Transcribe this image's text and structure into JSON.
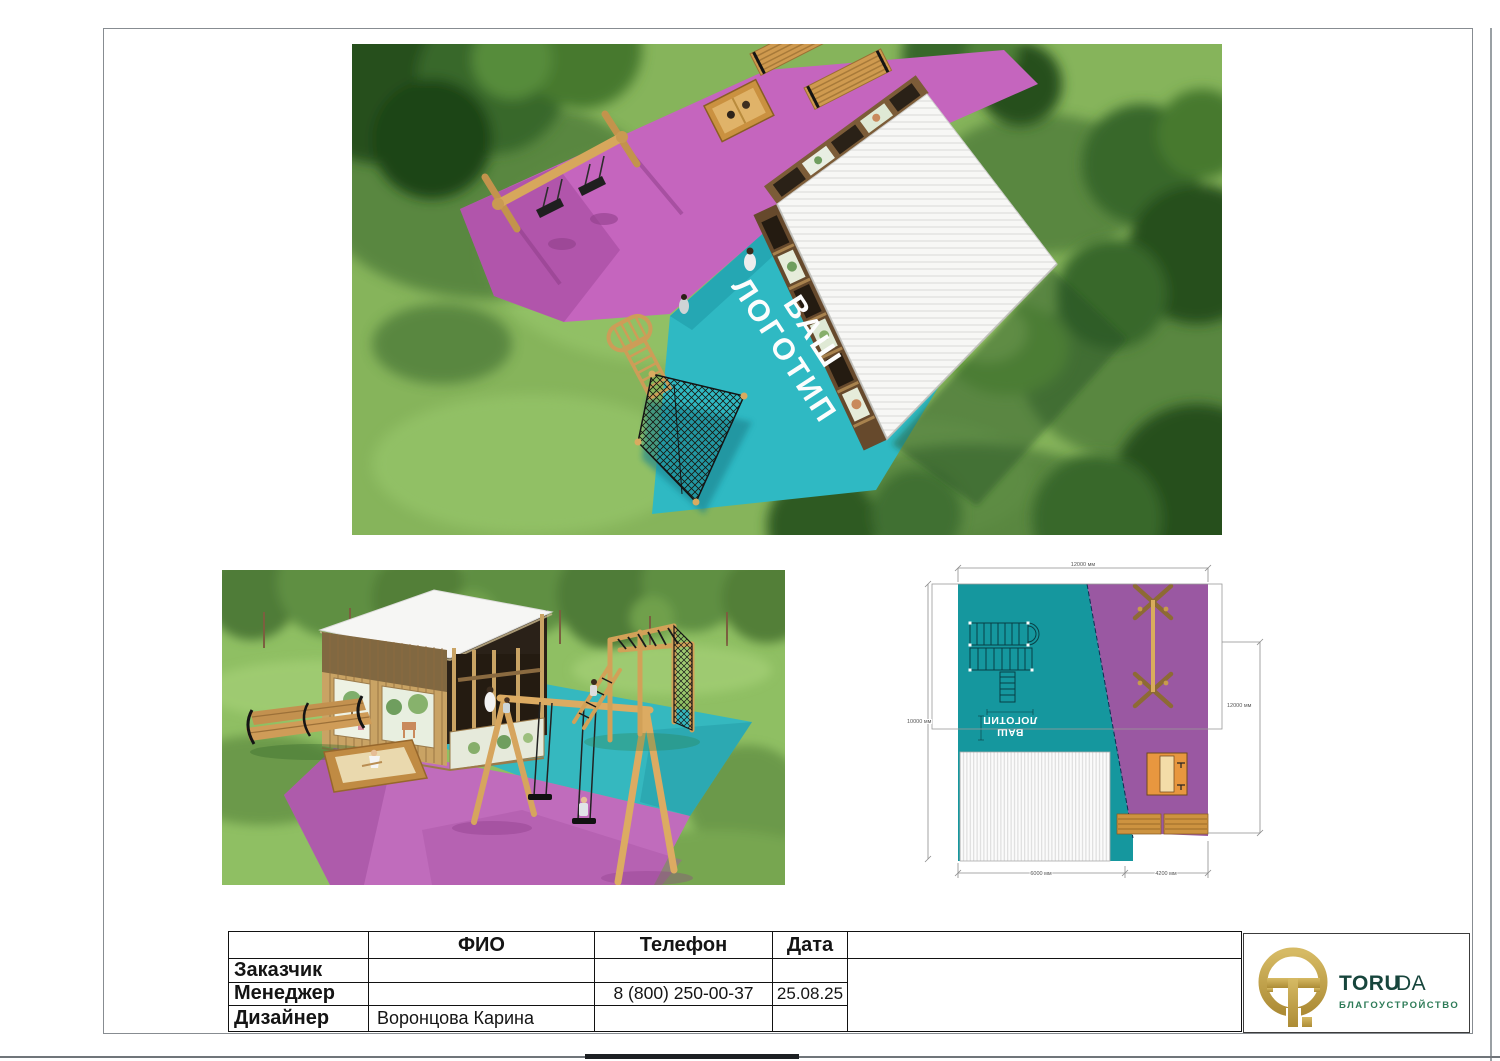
{
  "sheet": {
    "titleblock": {
      "col_fio": "ФИО",
      "col_phone": "Телефон",
      "col_date": "Дата",
      "row_customer": "Заказчик",
      "row_manager": "Менеджер",
      "row_designer": "Дизайнер",
      "customer_fio": "",
      "customer_phone": "",
      "customer_date": "",
      "manager_fio": "",
      "manager_phone": "8 (800) 250-00-37",
      "manager_date": "25.08.25",
      "designer_fio": "Воронцова Карина",
      "designer_phone": "",
      "designer_date": ""
    },
    "brand": {
      "name_bold": "TORU",
      "name_light": "DA",
      "tagline": "БЛАГОУСТРОЙСТВО"
    },
    "logo_placeholder": {
      "line1": "ВАШ",
      "line2": "ЛОГОТИП"
    },
    "plan_dims": {
      "top": "12000 мм",
      "left": "10000 мм",
      "right": "12000 мм",
      "bottom_left": "6000 мм",
      "bottom_right": "4200 мм"
    },
    "colors": {
      "teal_render": "#2FB9C3",
      "teal_plan": "#15979E",
      "pink_render": "#C565BE",
      "purple_plan": "#9A58A2",
      "gold": "#C2A14B",
      "brand_green": "#17453C"
    }
  }
}
